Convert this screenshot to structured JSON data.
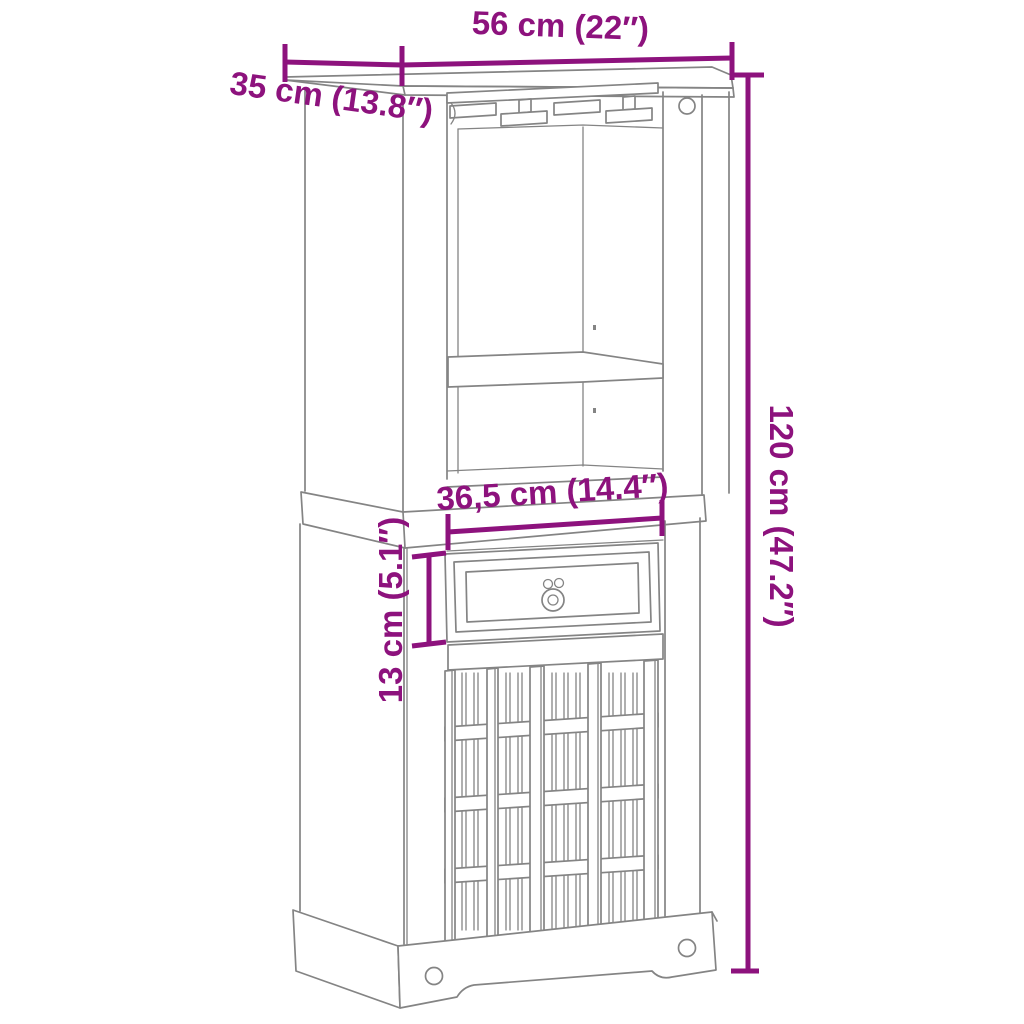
{
  "diagram": {
    "type": "product-dimension-diagram",
    "subject": "wine bar cabinet with glass rack, open shelves, drawer and bottle rack",
    "background_color": "#ffffff",
    "line_color": "#848484",
    "dimension_color": "#8D127D",
    "labels": {
      "width": "56 cm (22″)",
      "depth": "35 cm (13.8″)",
      "height": "120 cm (47.2″)",
      "inner_width": "36,5 cm (14.4″)",
      "drawer_height": "13 cm (5.1″)"
    }
  }
}
